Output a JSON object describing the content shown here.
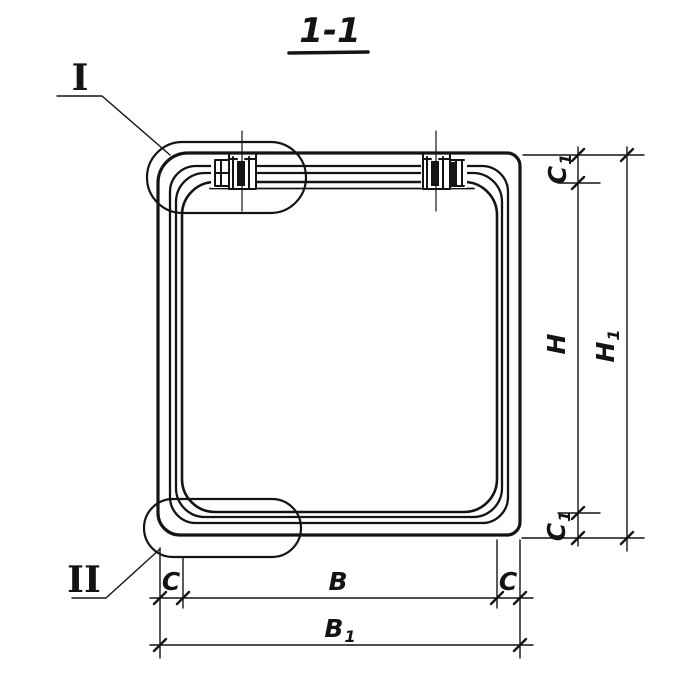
{
  "title": {
    "text": "1-1"
  },
  "callouts": {
    "detail_top": "I",
    "detail_bottom": "II"
  },
  "dims": {
    "c1_top": {
      "base": "C",
      "sub": "1"
    },
    "h": {
      "base": "H"
    },
    "c1_bottom": {
      "base": "C",
      "sub": "1"
    },
    "h1": {
      "base": "H",
      "sub": "1"
    },
    "c_left": {
      "base": "C"
    },
    "b": {
      "base": "B"
    },
    "c_right": {
      "base": "C"
    },
    "b1": {
      "base": "B",
      "sub": "1"
    }
  },
  "colors": {
    "ink": "#141414",
    "background": "#ffffff"
  }
}
